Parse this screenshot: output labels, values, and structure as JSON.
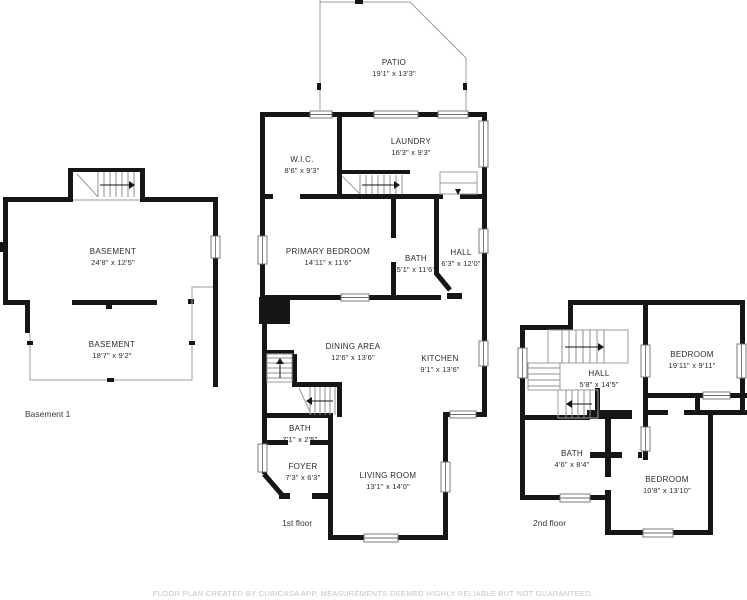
{
  "footer": "FLOOR PLAN CREATED BY CUBICASA APP. MEASUREMENTS DEEMED HIGHLY RELIABLE BUT NOT GUARANTEED.",
  "floor_labels": {
    "basement": "Basement 1",
    "first": "1st floor",
    "second": "2nd floor"
  },
  "rooms": {
    "patio": {
      "name": "PATIO",
      "dims": "19'1\" x 13'3\""
    },
    "wic": {
      "name": "W.I.C.",
      "dims": "8'6\" x 9'3\""
    },
    "laundry": {
      "name": "LAUNDRY",
      "dims": "16'3\" x 9'3\""
    },
    "primary_bedroom": {
      "name": "PRIMARY BEDROOM",
      "dims": "14'11\" x 11'6\""
    },
    "bath_first": {
      "name": "BATH",
      "dims": "5'1\" x 11'6\""
    },
    "hall_first": {
      "name": "HALL",
      "dims": "6'3\" x 12'0\""
    },
    "dining": {
      "name": "DINING AREA",
      "dims": "12'6\" x 13'6\""
    },
    "kitchen": {
      "name": "KITCHEN",
      "dims": "9'1\" x 13'6\""
    },
    "bath_foyer": {
      "name": "BATH",
      "dims": "7'1\" x 2'5\""
    },
    "foyer": {
      "name": "FOYER",
      "dims": "7'3\" x 6'3\""
    },
    "living": {
      "name": "LIVING ROOM",
      "dims": "13'1\" x 14'0\""
    },
    "basement_main": {
      "name": "BASEMENT",
      "dims": "24'8\" x 12'5\""
    },
    "basement_lower": {
      "name": "BASEMENT",
      "dims": "18'7\" x 9'2\""
    },
    "hall_second": {
      "name": "HALL",
      "dims": "5'8\" x 14'5\""
    },
    "bedroom_upper": {
      "name": "BEDROOM",
      "dims": "19'11\" x 9'11\""
    },
    "bath_second": {
      "name": "BATH",
      "dims": "4'6\" x 8'4\""
    },
    "bedroom_lower": {
      "name": "BEDROOM",
      "dims": "10'8\" x 13'10\""
    }
  },
  "colors": {
    "wall": "#161616",
    "thin_line": "#9c9c9c",
    "label": "#2b2b2b",
    "footer": "#c4c4c4",
    "background": "#ffffff"
  }
}
